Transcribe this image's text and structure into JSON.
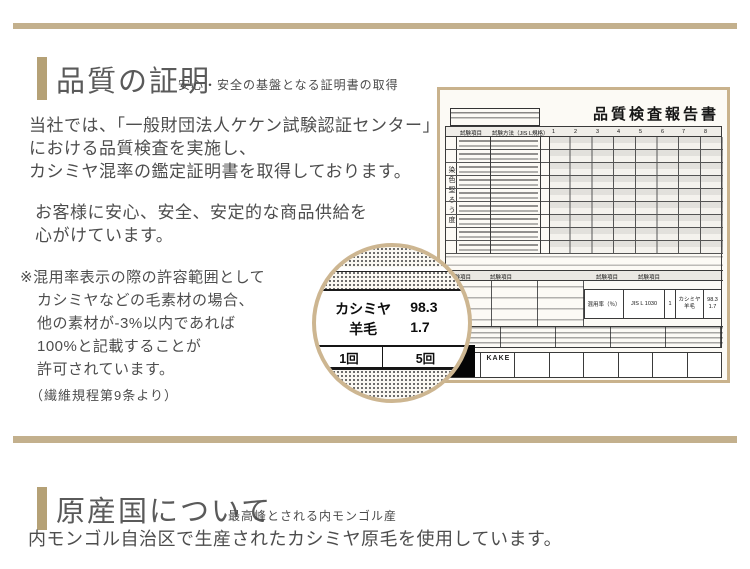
{
  "colors": {
    "accent": "#b5a176",
    "rule": "#c3b08d",
    "cert_border": "#c9b28c"
  },
  "quality": {
    "title": "品質の証明",
    "subtitle": "安心・安全の基盤となる証明書の取得",
    "p1": [
      "当社では、「一般財団法人ケケン試験認証センター」",
      "における品質検査を実施し、",
      "カシミヤ混率の鑑定証明書を取得しております。"
    ],
    "p2": [
      "お客様に安心、安全、安定的な商品供給を",
      "心がけています。"
    ],
    "note": [
      "※混用率表示の際の許容範囲として",
      "カシミヤなどの毛素材の場合、",
      "他の素材が-3%以内であれば",
      "100%と記載することが",
      "許可されています。"
    ],
    "note_source": "（繊維規程第9条より）"
  },
  "certificate": {
    "title": "品質検査報告書",
    "col_item": "試験項目",
    "col_method": "試験方法（JIS L規格）",
    "col_numbers": [
      "1",
      "2",
      "3",
      "4",
      "5",
      "6",
      "7",
      "8"
    ],
    "side_label": "染色堅ろう度",
    "mixture": {
      "label": "混用率（％）",
      "method": "JIS L 1030",
      "count": "1",
      "fiber1": "カシミヤ",
      "value1": "98.3",
      "fiber2": "羊毛",
      "value2": "1.7"
    },
    "kake": "KAKE"
  },
  "magnifier": {
    "fiber1": "カシミヤ",
    "value1": "98.3",
    "fiber2": "羊毛",
    "value2": "1.7",
    "cell_left": "1回",
    "cell_right": "5回"
  },
  "origin": {
    "title": "原産国について",
    "subtitle": "最高峰とされる内モンゴル産",
    "body": "内モンゴル自治区で生産されたカシミヤ原毛を使用しています。"
  }
}
